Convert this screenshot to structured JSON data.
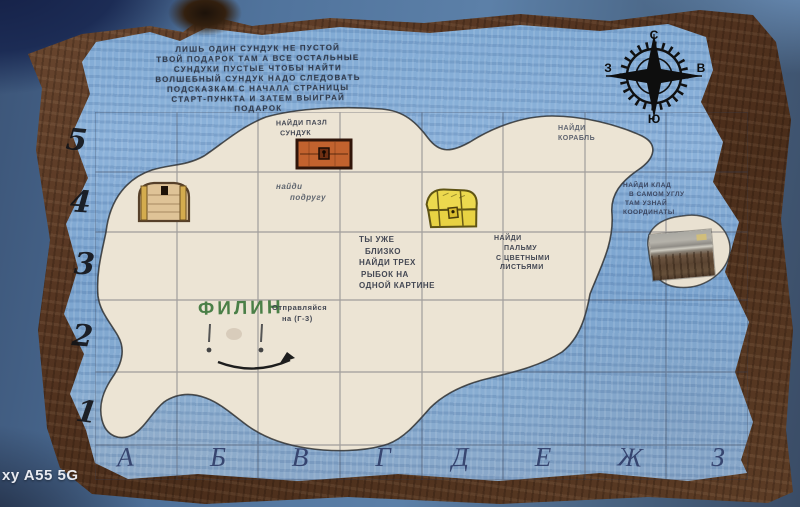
{
  "photo": {
    "watermark": "xy A55 5G"
  },
  "legend": {
    "lines": [
      "ЛИШЬ ОДИН СУНДУК НЕ ПУСТОЙ",
      "ТВОЙ ПОДАРОК ТАМ А ВСЕ ОСТАЛЬНЫЕ",
      "СУНДУКИ ПУСТЫЕ ЧТОБЫ НАЙТИ",
      "ВОЛШЕБНЫЙ СУНДУК НАДО СЛЕДОВАТЬ",
      "ПОДСКАЗКАМ С НАЧАЛА СТРАНИЦЫ",
      "СТАРТ-ПУНКТА И ЗАТЕМ ВЫИГРАЙ",
      "ПОДАРОК"
    ]
  },
  "compass": {
    "north": "С",
    "east": "В",
    "south": "Ю",
    "west": "З"
  },
  "axes": {
    "rows": [
      "5",
      "4",
      "3",
      "2",
      "1"
    ],
    "cols": [
      "А",
      "Б",
      "В",
      "Г",
      "Д",
      "Е",
      "Ж",
      "З"
    ]
  },
  "clues": {
    "puzzle_chest": {
      "cell": "В5",
      "line1": "НАЙДИ ПАЗЛ",
      "line2": "СУНДУК"
    },
    "ship": {
      "cell": "Е5",
      "line1": "НАЙДИ",
      "line2": "КОРАБЛЬ"
    },
    "friend": {
      "cell": "В4",
      "line1": "найди",
      "line2": "подругу"
    },
    "treasure_corner": {
      "cell": "З4",
      "line1": "НАЙДИ КЛАД",
      "line2": "В САМОМ УГЛУ",
      "line3": "ТАМ УЗНАЙ",
      "line4": "КООРДИНАТЫ"
    },
    "three_fish": {
      "cell": "Г3",
      "line1": "ТЫ УЖЕ",
      "line2": "БЛИЗКО",
      "line3": "НАЙДИ ТРЕХ",
      "line4": "РЫБОК НА",
      "line5": "ОДНОЙ КАРТИНЕ"
    },
    "palm": {
      "cell": "Е3",
      "line1": "НАЙДИ",
      "line2": "ПАЛЬМУ",
      "line3": "С ЦВЕТНЫМИ",
      "line4": "ЛИСТЬЯМИ"
    },
    "owl": {
      "cell": "Б2",
      "label": "ФИЛИН"
    },
    "start": {
      "cell": "В2",
      "line1": "Отправляйся",
      "line2": "на (Г-3)"
    }
  },
  "markers": {
    "tan_chest": "closed-wooden-chest-icon",
    "orange_chest": "orange-chest-icon",
    "yellow_chest": "yellow-treasure-chest-icon",
    "photo_chest": "glued-photo-of-real-chest",
    "owl_face": "owl-eyes-and-smile-arrow-drawing"
  },
  "colors": {
    "sea": "#85add6",
    "island": "#ece4d4",
    "parchment_border": "#5a3a25",
    "table": "#4d6d94",
    "pencil_text": "#3a4150",
    "owl_green": "#3f7a3c"
  }
}
